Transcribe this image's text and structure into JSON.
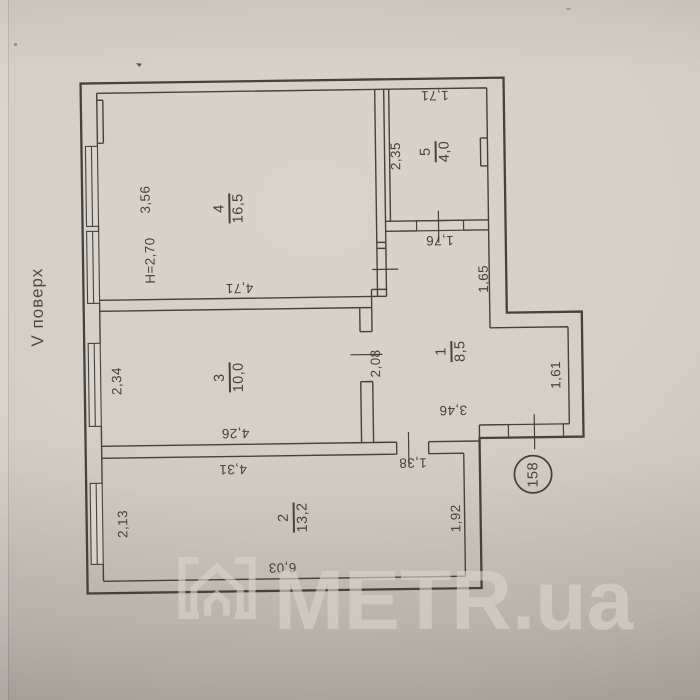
{
  "meta": {
    "floor_label": "V поверх",
    "ceiling_height": "H=2,70",
    "apartment_number": "158",
    "watermark_text": "METR.ua"
  },
  "rooms": {
    "r1": {
      "num": "1",
      "area": "8,5"
    },
    "r2": {
      "num": "2",
      "area": "13,2"
    },
    "r3": {
      "num": "3",
      "area": "10,0"
    },
    "r4": {
      "num": "4",
      "area": "16,5"
    },
    "r5": {
      "num": "5",
      "area": "4,0"
    }
  },
  "dims": {
    "room4_width": "3,56",
    "room4_length": "4,71",
    "room5_width": "1,71",
    "room5_depth": "2,35",
    "corridor_width": "1,76",
    "corridor_depth": "1,65",
    "room3_depth": "2,34",
    "room3_width": "4,26",
    "room3_width_outer": "4,31",
    "hall_wall": "2,08",
    "hall_width": "3,46",
    "hall_door": "1,38",
    "hall_depth": "1,61",
    "room2_depth": "2,13",
    "room2_width": "6,03",
    "room2_right": "1,92"
  },
  "colors": {
    "paper": "#d4cfc6",
    "ink": "#45423c",
    "watermark": "#d9d5cd"
  }
}
